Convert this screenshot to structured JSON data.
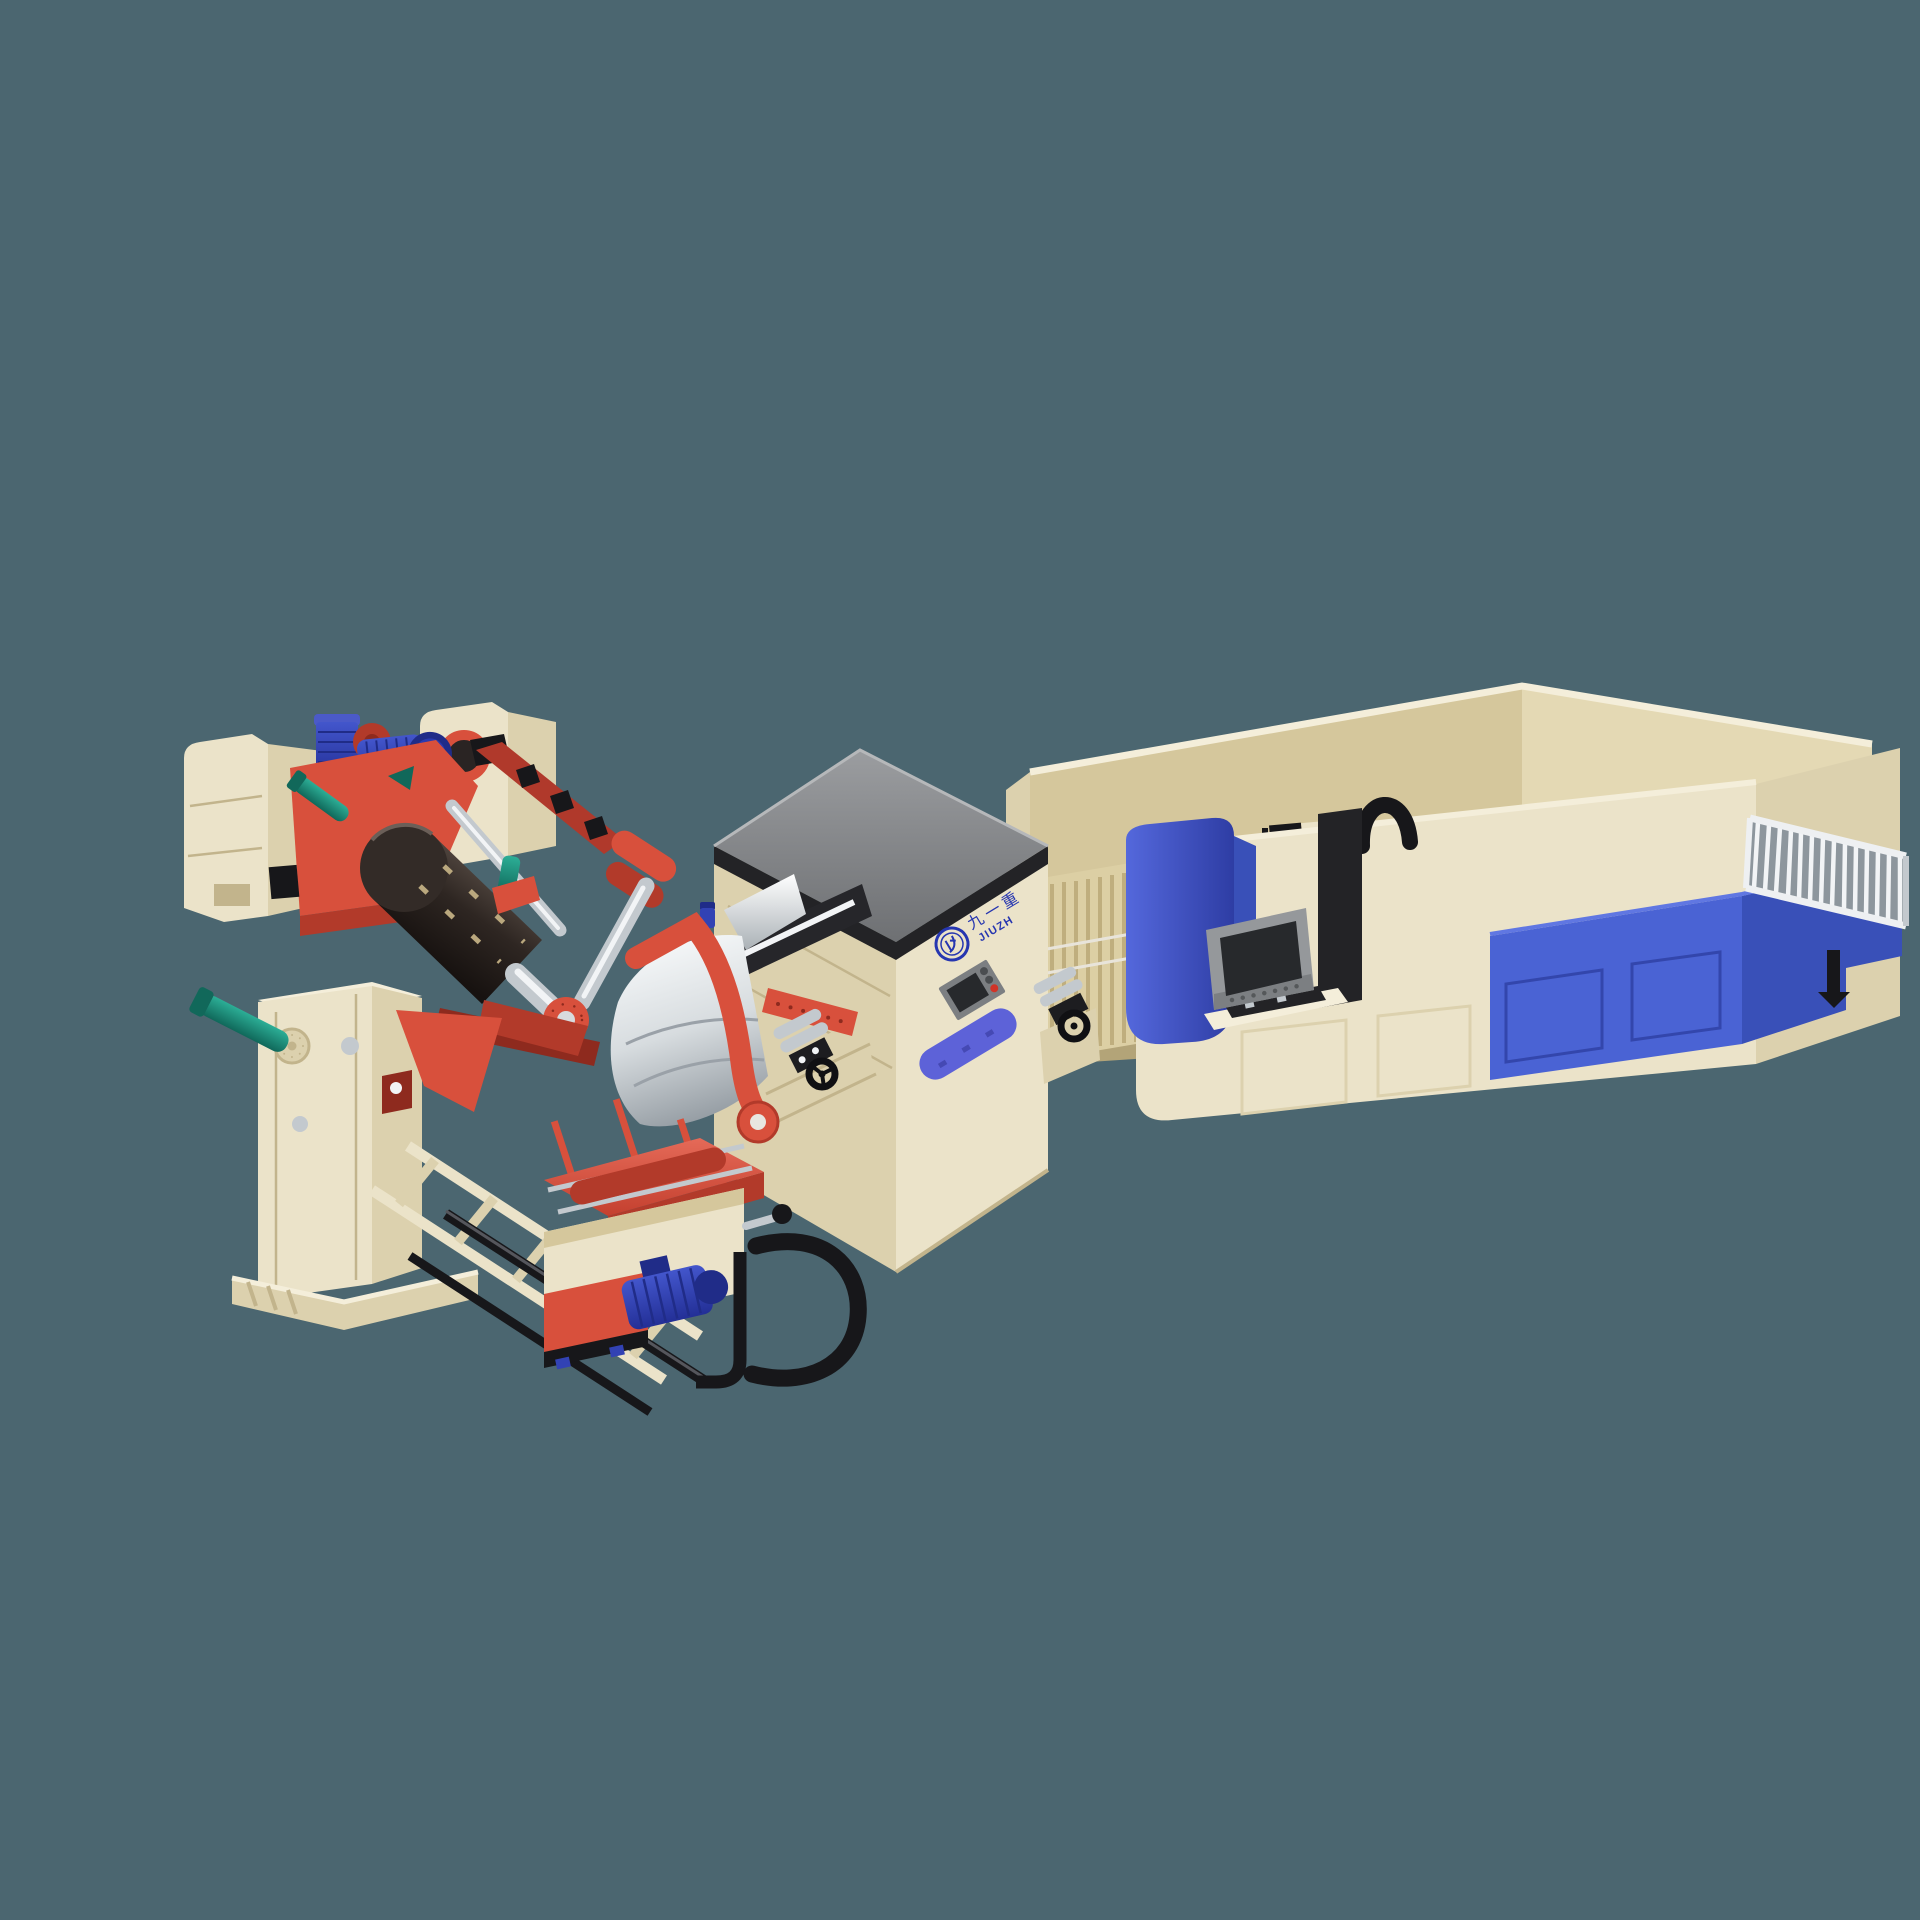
{
  "background": "#4b6670",
  "branding": {
    "logo_chinese": "九一重",
    "logo_latin": "JIUZH"
  },
  "palette": {
    "bg": "#4b6670",
    "cream-top": "#f4eeda",
    "cream": "#ebe3c9",
    "cream-shade": "#dcd1ae",
    "cream-deep": "#c2b48c",
    "tan-light": "#e4d9b4",
    "tan": "#d5c79c",
    "tan-dark": "#b3a478",
    "slat": "#dccfa4",
    "slat-line": "#bfae7e",
    "gray-top": "#6e7073",
    "gray-top-light": "#9b9da0",
    "trim-black": "#232326",
    "red": "#d8503c",
    "red-dark": "#b23a2a",
    "red-deep": "#8e2a1e",
    "blue-motor": "#3242b4",
    "blue-motor-dark": "#202c88",
    "blue-motor-light": "#4b5ac8",
    "blue-panel": "#4a63d4",
    "blue-panel-dark": "#3950b8",
    "blue-panel-light": "#6077e2",
    "blue-badge": "#5d62d8",
    "teal": "#1d9480",
    "teal-dark": "#11685a",
    "silver-bright": "#f2f4f6",
    "silver": "#c3c9ce",
    "silver-dark": "#8d969d",
    "steel-dark": "#26262a",
    "hmi-gray": "#95989b",
    "hmi-gray-dark": "#7c7f82",
    "hmi-screen": "#27292c",
    "drum-light": "#6b5e55",
    "drum-dark": "#171210",
    "drum-face": "#332b27",
    "white-rail": "#eef0f2",
    "logo-blue": "#2636b0",
    "button-red": "#d03428",
    "button-gray": "#4a4d50",
    "ink-black": "#17171a"
  }
}
